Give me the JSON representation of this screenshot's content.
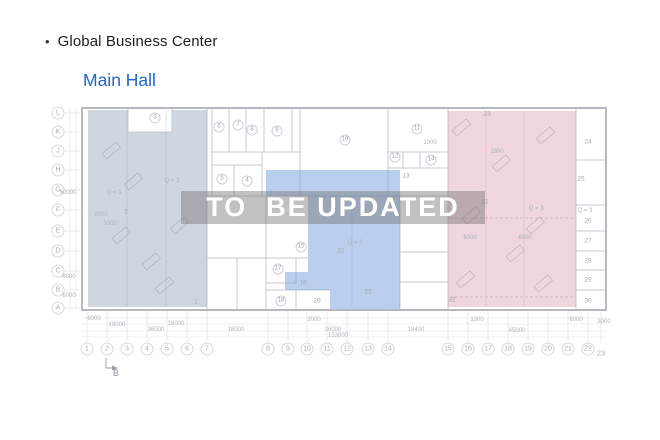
{
  "header": {
    "bullet": "•",
    "title": "Global Business Center",
    "subtitle": "Main Hall"
  },
  "watermark": {
    "text": "TO  BE UPDATED"
  },
  "colors": {
    "accent_blue": "#2066c9",
    "title_text": "#1d1d1f",
    "zone_left_fill": "#96a5ba",
    "zone_middle_fill": "#6f9bd9",
    "zone_right_fill": "#d898ae",
    "watermark_band": "rgba(118,118,118,0.45)",
    "watermark_text": "#ffffff",
    "plan_line": "#c6c9cf"
  },
  "plan": {
    "row_labels": [
      {
        "t": "L",
        "y": 113
      },
      {
        "t": "K",
        "y": 132
      },
      {
        "t": "J",
        "y": 151
      },
      {
        "t": "H",
        "y": 170
      },
      {
        "t": "G",
        "y": 190
      },
      {
        "t": "F",
        "y": 210
      },
      {
        "t": "E",
        "y": 231
      },
      {
        "t": "D",
        "y": 251
      },
      {
        "t": "C",
        "y": 271
      },
      {
        "t": "B",
        "y": 290
      },
      {
        "t": "A",
        "y": 308
      }
    ],
    "col_labels": [
      {
        "t": "1",
        "x": 87
      },
      {
        "t": "2",
        "x": 107
      },
      {
        "t": "3",
        "x": 127
      },
      {
        "t": "4",
        "x": 147
      },
      {
        "t": "5",
        "x": 167
      },
      {
        "t": "6",
        "x": 187
      },
      {
        "t": "7",
        "x": 207
      },
      {
        "t": "8",
        "x": 268
      },
      {
        "t": "9",
        "x": 288
      },
      {
        "t": "10",
        "x": 307
      },
      {
        "t": "11",
        "x": 327
      },
      {
        "t": "12",
        "x": 347
      },
      {
        "t": "13",
        "x": 368
      },
      {
        "t": "14",
        "x": 388
      },
      {
        "t": "15",
        "x": 448
      },
      {
        "t": "16",
        "x": 468
      },
      {
        "t": "17",
        "x": 488
      },
      {
        "t": "18",
        "x": 508
      },
      {
        "t": "19",
        "x": 528
      },
      {
        "t": "20",
        "x": 548
      },
      {
        "t": "21",
        "x": 568
      },
      {
        "t": "22",
        "x": 588
      },
      {
        "t": "23",
        "x": 601,
        "y": 353,
        "plain": 1
      }
    ],
    "rooms": [
      {
        "t": "3",
        "x": 155,
        "y": 118,
        "c": 1
      },
      {
        "t": "6",
        "x": 219,
        "y": 127,
        "c": 1
      },
      {
        "t": "7",
        "x": 238,
        "y": 125,
        "c": 1
      },
      {
        "t": "8",
        "x": 252,
        "y": 130,
        "c": 1
      },
      {
        "t": "9",
        "x": 277,
        "y": 131,
        "c": 1
      },
      {
        "t": "5",
        "x": 222,
        "y": 179,
        "c": 1
      },
      {
        "t": "4",
        "x": 247,
        "y": 181,
        "c": 1
      },
      {
        "t": "10",
        "x": 345,
        "y": 140,
        "c": 1
      },
      {
        "t": "11",
        "x": 417,
        "y": 129,
        "c": 1
      },
      {
        "t": "12",
        "x": 395,
        "y": 157,
        "c": 1
      },
      {
        "t": "13",
        "x": 406,
        "y": 176,
        "c": 0
      },
      {
        "t": "14",
        "x": 431,
        "y": 160,
        "c": 1
      },
      {
        "t": "15",
        "x": 301,
        "y": 247,
        "c": 1
      },
      {
        "t": "17",
        "x": 278,
        "y": 269,
        "c": 1
      },
      {
        "t": "18",
        "x": 281,
        "y": 301,
        "c": 1
      },
      {
        "t": "19",
        "x": 303,
        "y": 283,
        "c": 0
      },
      {
        "t": "20",
        "x": 317,
        "y": 301,
        "c": 0
      },
      {
        "t": "21",
        "x": 341,
        "y": 251,
        "c": 0
      },
      {
        "t": "22",
        "x": 368,
        "y": 292,
        "c": 0
      },
      {
        "t": "2",
        "x": 126,
        "y": 212,
        "c": 0
      },
      {
        "t": "1",
        "x": 196,
        "y": 302,
        "c": 0
      },
      {
        "t": "23",
        "x": 487,
        "y": 114,
        "c": 0
      },
      {
        "t": "31",
        "x": 485,
        "y": 202,
        "c": 0
      },
      {
        "t": "32",
        "x": 452,
        "y": 300,
        "c": 0
      },
      {
        "t": "24",
        "x": 588,
        "y": 142,
        "c": 0
      },
      {
        "t": "25",
        "x": 581,
        "y": 179,
        "c": 0
      },
      {
        "t": "26",
        "x": 588,
        "y": 221,
        "c": 0
      },
      {
        "t": "27",
        "x": 588,
        "y": 241,
        "c": 0
      },
      {
        "t": "28",
        "x": 588,
        "y": 261,
        "c": 0
      },
      {
        "t": "29",
        "x": 588,
        "y": 280,
        "c": 0
      },
      {
        "t": "30",
        "x": 588,
        "y": 301,
        "c": 0
      }
    ],
    "texts": [
      {
        "t": "Q = 3",
        "x": 172,
        "y": 181
      },
      {
        "t": "Q = 3",
        "x": 114,
        "y": 193
      },
      {
        "t": "Q = 3",
        "x": 355,
        "y": 243
      },
      {
        "t": "Q = 3",
        "x": 536,
        "y": 209
      },
      {
        "t": "Q = 3",
        "x": 585,
        "y": 211
      },
      {
        "t": "2000",
        "x": 101,
        "y": 215
      },
      {
        "t": "1000",
        "x": 430,
        "y": 143
      },
      {
        "t": "1800",
        "x": 497,
        "y": 152
      },
      {
        "t": "60000",
        "x": 68,
        "y": 193,
        "rot": 1
      },
      {
        "t": "5000",
        "x": 110,
        "y": 224,
        "rot": 1
      },
      {
        "t": "6000",
        "x": 69,
        "y": 277,
        "rot": 1
      },
      {
        "t": "6000",
        "x": 69,
        "y": 296,
        "rot": 1
      },
      {
        "t": "6000",
        "x": 470,
        "y": 238,
        "rot": 1
      },
      {
        "t": "6000",
        "x": 525,
        "y": 238,
        "rot": 1
      }
    ],
    "dims": [
      {
        "t": "6000",
        "x": 94,
        "y": 319
      },
      {
        "t": "18000",
        "x": 117,
        "y": 325
      },
      {
        "t": "18000",
        "x": 176,
        "y": 324
      },
      {
        "t": "2000",
        "x": 314,
        "y": 320
      },
      {
        "t": "1300",
        "x": 477,
        "y": 320
      },
      {
        "t": "6000",
        "x": 576,
        "y": 320
      },
      {
        "t": "3000",
        "x": 604,
        "y": 322
      },
      {
        "t": "36000",
        "x": 156,
        "y": 330
      },
      {
        "t": "18000",
        "x": 236,
        "y": 330
      },
      {
        "t": "36000",
        "x": 333,
        "y": 330
      },
      {
        "t": "18400",
        "x": 416,
        "y": 330
      },
      {
        "t": "45000",
        "x": 517,
        "y": 331
      },
      {
        "t": "153800",
        "x": 338,
        "y": 336
      }
    ],
    "section_marker": {
      "t": "B",
      "x": 116,
      "y": 373
    }
  }
}
